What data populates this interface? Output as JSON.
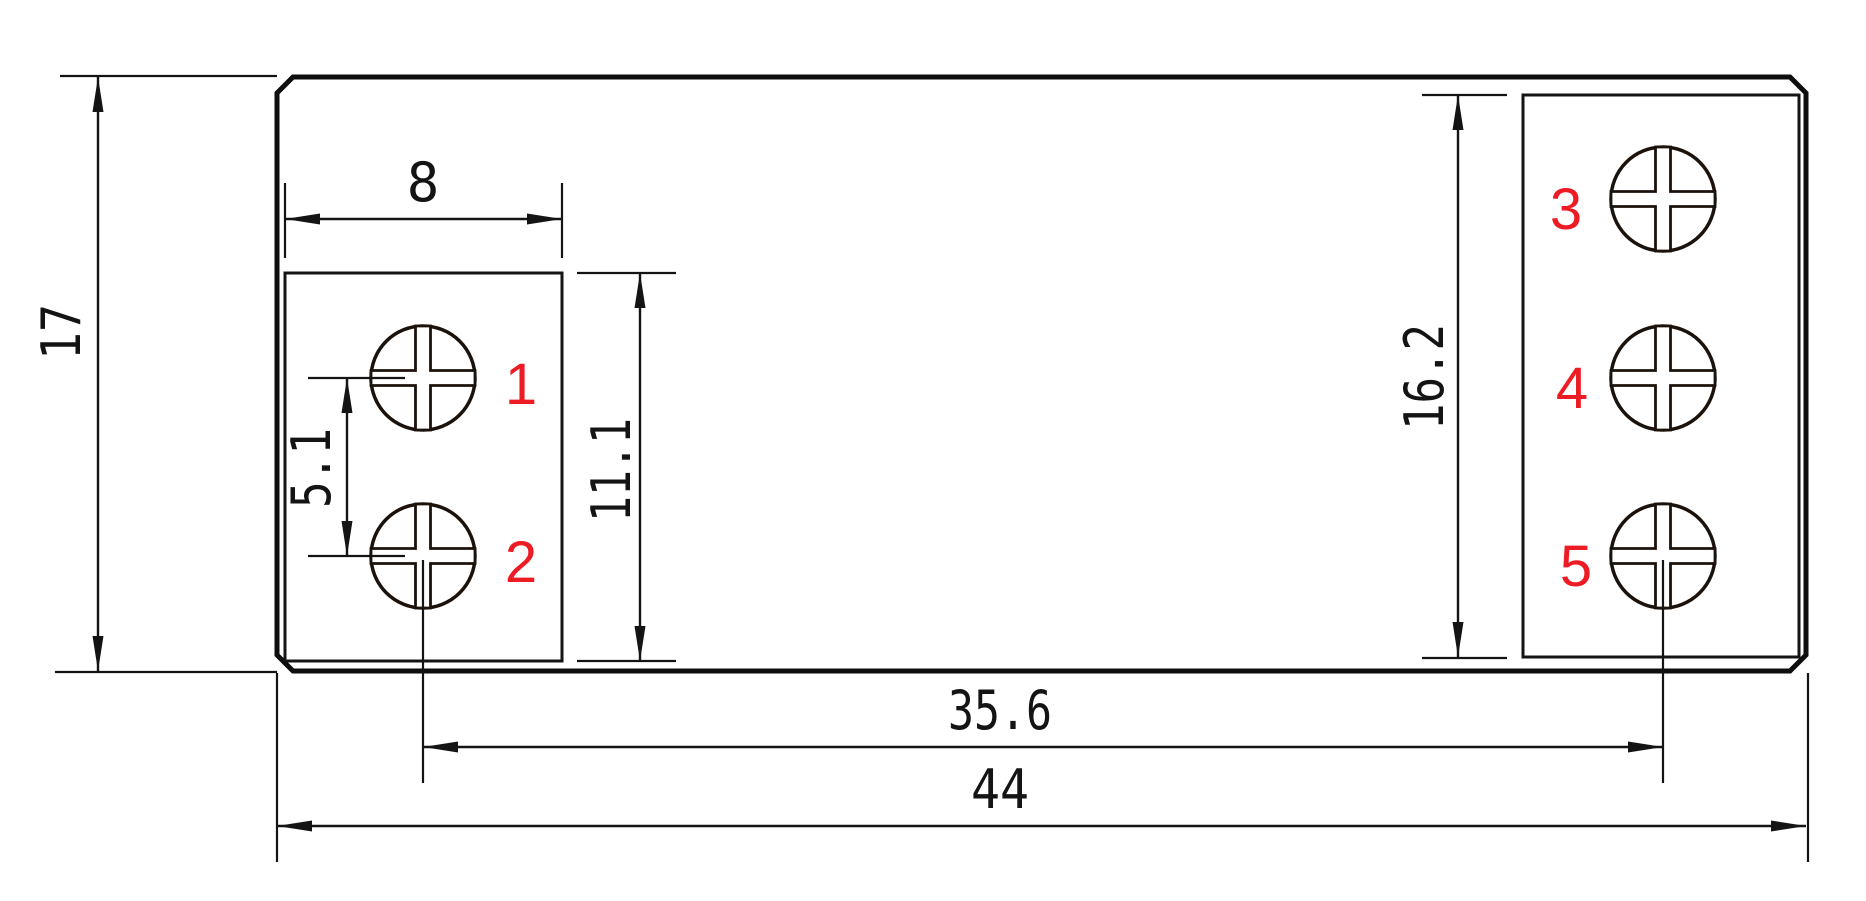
{
  "drawing": {
    "type": "dimensioned-part-drawing",
    "background_color": "#ffffff",
    "line_color": "#141414",
    "screw_outline_color": "#1c120c",
    "terminal_label_color": "#ed1c24",
    "dimensions": {
      "overall_width": {
        "label": "44"
      },
      "overall_height": {
        "label": "17"
      },
      "terminal_box_width": {
        "label": "8"
      },
      "terminal_pitch": {
        "label": "5.1"
      },
      "left_box_height": {
        "label": "11.1"
      },
      "right_box_height": {
        "label": "16.2"
      },
      "screw_center_span": {
        "label": "35.6"
      }
    },
    "terminals": [
      {
        "id": "1"
      },
      {
        "id": "2"
      },
      {
        "id": "3"
      },
      {
        "id": "4"
      },
      {
        "id": "5"
      }
    ]
  }
}
